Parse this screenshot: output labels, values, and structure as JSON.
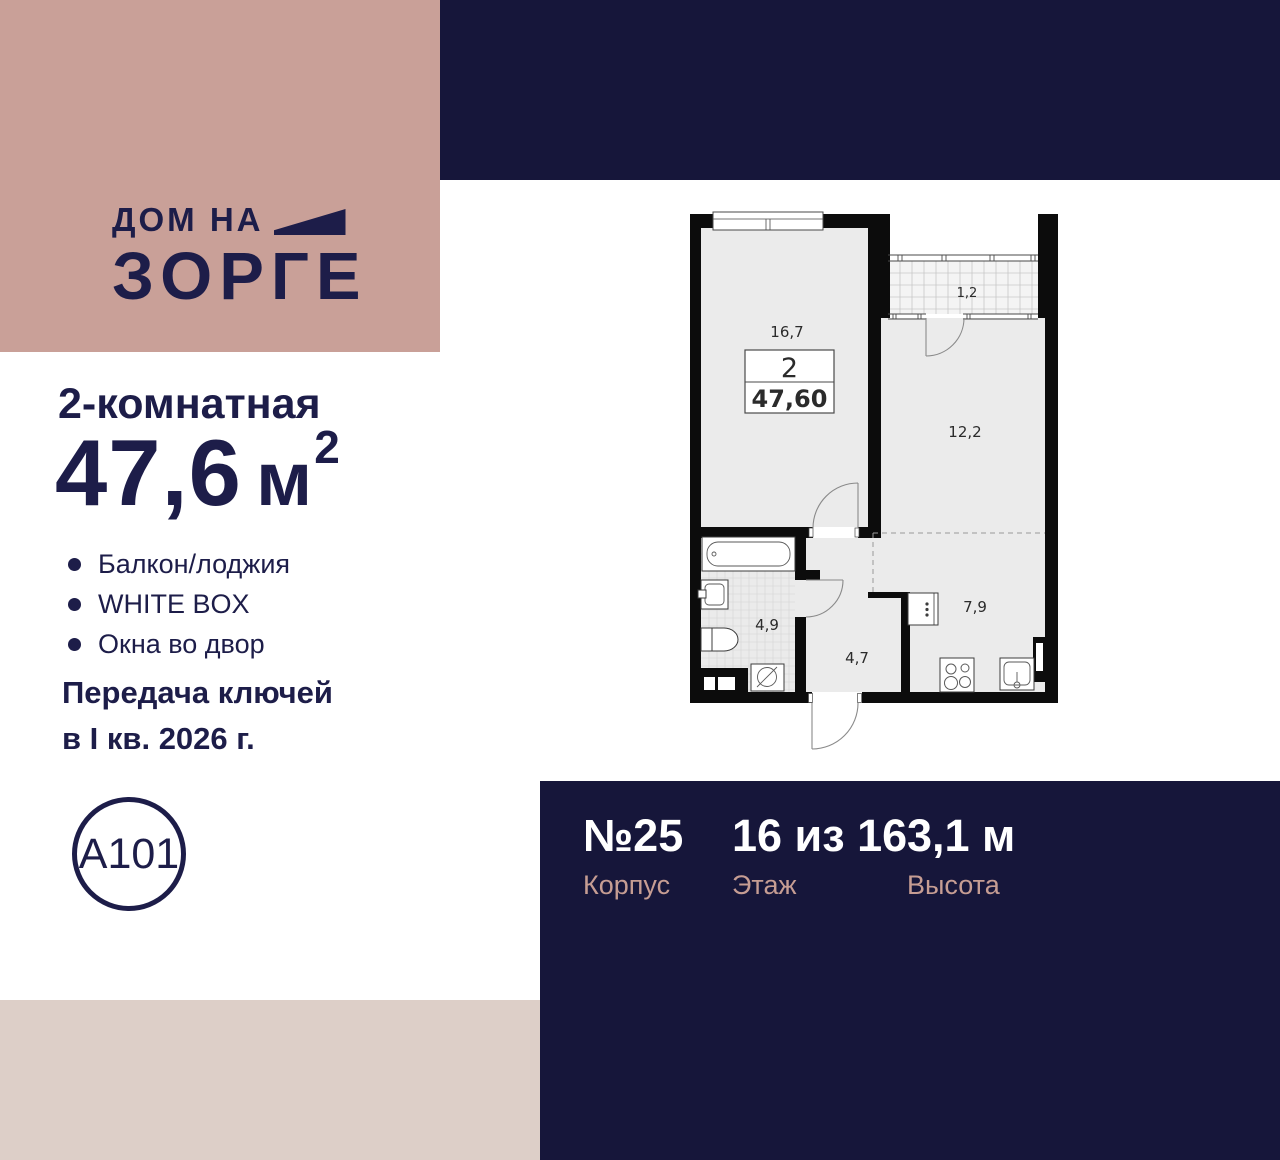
{
  "brand": {
    "logo_line1": "ДОМ НА",
    "logo_line2": "ЗОРГЕ",
    "developer_logo": "A101"
  },
  "listing": {
    "title": "2-комнатная",
    "area_value": "47,6",
    "area_unit": "м",
    "area_sup": "2",
    "features": [
      {
        "label": "Балкон/лоджия"
      },
      {
        "label": "WHITE BOX"
      },
      {
        "label": "Окна во двор"
      }
    ],
    "handover_line1": "Передача ключей",
    "handover_line2": "в I кв. 2026 г."
  },
  "floorplan": {
    "badge": {
      "rooms": "2",
      "total_area": "47,60"
    },
    "rooms": [
      {
        "name": "bedroom",
        "area": "16,7"
      },
      {
        "name": "balcony",
        "area": "1,2"
      },
      {
        "name": "living-room",
        "area": "12,2"
      },
      {
        "name": "bathroom",
        "area": "4,9"
      },
      {
        "name": "hallway",
        "area": "4,7"
      },
      {
        "name": "kitchen",
        "area": "7,9"
      }
    ]
  },
  "specs": [
    {
      "value": "№25",
      "label": "Корпус"
    },
    {
      "value": "16 из 16",
      "label": "Этаж"
    },
    {
      "value": "3,1 м",
      "label": "Высота"
    }
  ],
  "colors": {
    "brand_beige": "#c9a098",
    "brand_beige_light": "#ddcfc8",
    "brand_navy": "#16163a",
    "text_navy": "#1d1d49",
    "accent_rose": "#c69d93"
  }
}
